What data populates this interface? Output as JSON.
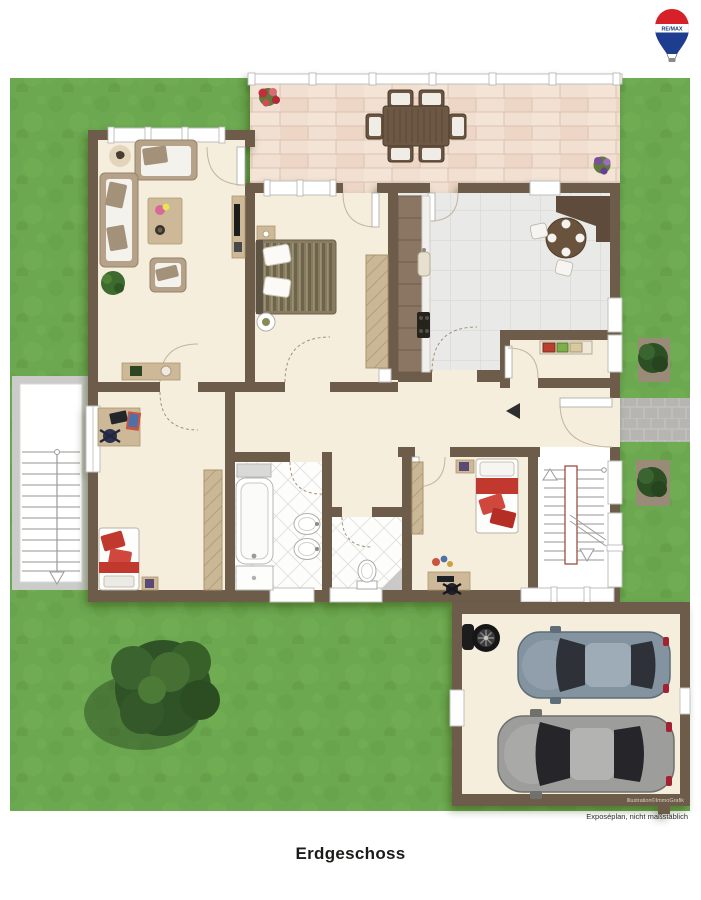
{
  "page": {
    "background": "#ffffff",
    "floor_label": "Erdgeschoss",
    "disclaimer": "Exposéplan, nicht maßstäblich",
    "watermark": "Illustration©ImmoGrafik"
  },
  "logo": {
    "brand": "RE/MAX",
    "balloon_red": "#d6212a",
    "balloon_blue": "#1d3e8f",
    "balloon_white": "#ffffff",
    "text_blue": "#16387c"
  },
  "palette": {
    "grass": "#6ba84f",
    "wall": "#6d5c4a",
    "room_floor": "#f6eedd",
    "terrace_brick": "#f1dfd1",
    "kitchen_tile": "#e9e9e7",
    "bath_tile": "#fdfdfc",
    "stair_floor": "#ffffff",
    "path_gray": "#b6b5b2",
    "accent_red": "#c23b33",
    "wood_light": "#cdb997",
    "wood_dark": "#6d5845",
    "bush_green": "#35592c"
  },
  "plan": {
    "areas": [
      "terrace",
      "living-room",
      "bedroom",
      "kitchen",
      "pantry",
      "hallway",
      "child-room",
      "bathroom",
      "wc",
      "bedroom-2",
      "stairwell",
      "garage"
    ],
    "garden_elements": [
      "lawn",
      "tree",
      "bush",
      "bush",
      "entrance-path",
      "exterior-stairs",
      "flower-pot",
      "flower-pot"
    ],
    "garage_contents": [
      "tire-stack",
      "car-blue-gray",
      "car-silver"
    ]
  }
}
